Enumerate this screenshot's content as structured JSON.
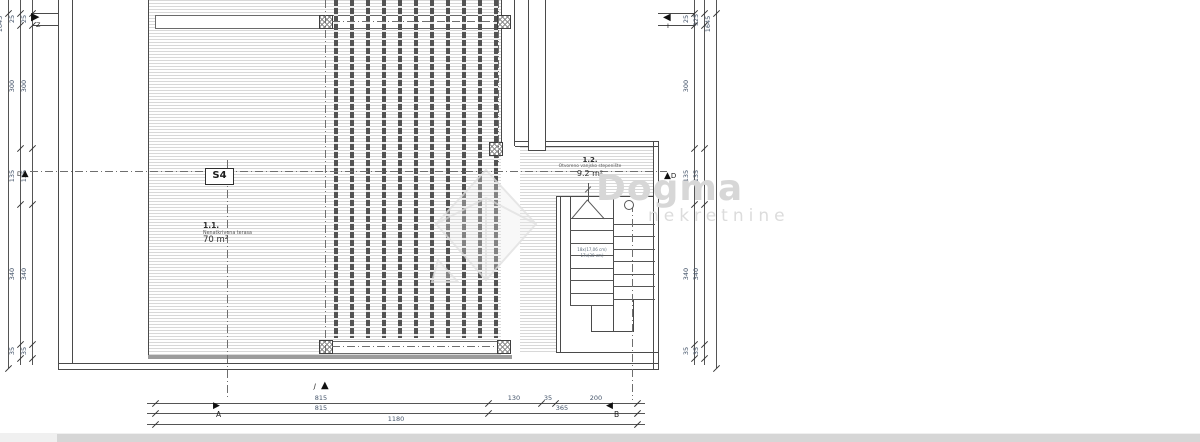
{
  "labels": {
    "section_box": "S4",
    "room1": {
      "id": "1.1.",
      "name": "Nenatkrivena terasa",
      "area": "70 m²"
    },
    "room2": {
      "id": "1.2.",
      "name": "Otvoreno vanjsko stepenište",
      "area": "9.2 m²"
    },
    "stair_note": [
      "18x(17,06 cm)",
      "17x(30 cm)"
    ]
  },
  "markers": {
    "west": "Z",
    "east": "I",
    "south": "J",
    "grid_row": "D",
    "axis_a": "A",
    "axis_b": "B"
  },
  "watermark": {
    "brand": "Dogma",
    "subtitle": "nekretnine"
  },
  "dimensions": {
    "left": {
      "overall": "1645",
      "outer": [
        "25",
        "300",
        "135",
        "340",
        "35"
      ],
      "inner": [
        "25",
        "300",
        "135",
        "340",
        "35"
      ]
    },
    "right": {
      "overall": "1645",
      "inner": [
        "25",
        "300",
        "135",
        "340",
        "35"
      ],
      "outer": [
        "925",
        "135",
        "340",
        "35"
      ]
    },
    "bottom": {
      "row1": [
        "815",
        "130",
        "35",
        "200"
      ],
      "row2": [
        "815",
        "365"
      ],
      "row3": [
        "1180"
      ]
    }
  },
  "colors": {
    "dim_text": "#44546a",
    "line": "#4a4a4a",
    "hatch": "#d8d8d8",
    "watermark": "#d7d7d7"
  }
}
